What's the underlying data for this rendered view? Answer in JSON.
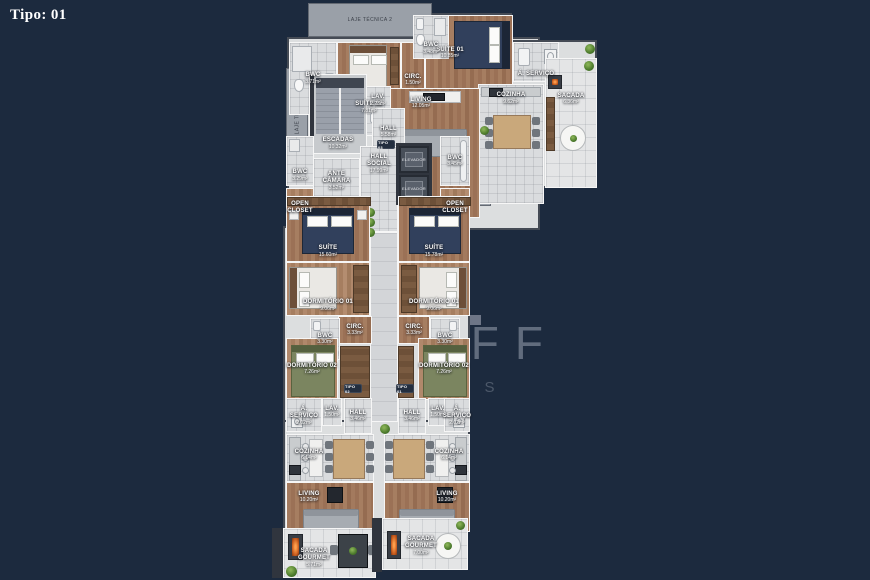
{
  "page": {
    "label": "Tipo: 01"
  },
  "watermark": {
    "brand": "WOLFF",
    "sub": "IMÓVEIS"
  },
  "colors": {
    "background": "#1c2a3e",
    "watermark": "#6e7888",
    "wood_floor": "#9c7156",
    "tile_floor": "#dadcde",
    "wall": "#454b55",
    "suite_bed": "#31405c",
    "grill_fire": "#c75b1e"
  },
  "strips": {
    "laje1": "LAJE TÉCNICA 1",
    "laje2": "LAJE TÉCNICA 2",
    "laje3": "LAJE TÉCNICA 3"
  },
  "tags": {
    "tipo01": "TIPO 01",
    "tipo02": "TIPO 02",
    "tipo03": "TIPO 03"
  },
  "rooms": {
    "bwc_top_left": {
      "name": "BWC",
      "area": "3.71m²"
    },
    "suite02": {
      "name": "SUÍTE 02",
      "area": "7.81m²"
    },
    "circ_top": {
      "name": "CIRC.",
      "area": "1.50m²"
    },
    "bwc_suite01": {
      "name": "BWC",
      "area": "3.48m²"
    },
    "suite01": {
      "name": "SUÍTE 01",
      "area": "10.85m²"
    },
    "servico_top": {
      "name": "Á. SERVIÇO",
      "area": ""
    },
    "cozinha_top": {
      "name": "COZINHA",
      "area": "9.62m²"
    },
    "sacada_top": {
      "name": "SACADA",
      "area": "6.36m²"
    },
    "living_top": {
      "name": "LIVING",
      "area": "12.05m²"
    },
    "lav_top": {
      "name": "LAV.",
      "area": "2.28m²"
    },
    "hall_top": {
      "name": "HALL",
      "area": "5.58m²"
    },
    "escadas": {
      "name": "ESCADAS",
      "area": "10.32m²"
    },
    "hall_social": {
      "name": "HALL SOCIAL",
      "area": "17.99m²"
    },
    "ante_camara": {
      "name": "ANTE CÂMARA",
      "area": "3.52m²"
    },
    "elevador": {
      "name": "ELEVADOR"
    },
    "bwc_mid_left": {
      "name": "BWC",
      "area": "3.29m²"
    },
    "open_closet_left": {
      "name": "OPEN CLOSET"
    },
    "bwc_mid_right": {
      "name": "BWC",
      "area": "3.45m²"
    },
    "open_closet_right": {
      "name": "OPEN CLOSET"
    },
    "suite_left": {
      "name": "SUÍTE",
      "area": "15.60m²"
    },
    "suite_right": {
      "name": "SUÍTE",
      "area": "15.78m²"
    },
    "dorm1_left": {
      "name": "DORMITÓRIO 01",
      "area": "9.06m²"
    },
    "dorm1_right": {
      "name": "DORMITÓRIO 01",
      "area": "9.06m²"
    },
    "circ_left": {
      "name": "CIRC.",
      "area": "3.33m²"
    },
    "circ_right": {
      "name": "CIRC.",
      "area": "3.33m²"
    },
    "bwc_low_left": {
      "name": "BWC",
      "area": "3.30m²"
    },
    "bwc_low_right": {
      "name": "BWC",
      "area": "3.30m²"
    },
    "dorm2_left": {
      "name": "DORMITÓRIO 02",
      "area": "7.26m²"
    },
    "dorm2_right": {
      "name": "DORMITÓRIO 02",
      "area": "7.26m²"
    },
    "lav_bot_left": {
      "name": "LAV.",
      "area": "1.50m²"
    },
    "lav_bot_right": {
      "name": "LAV.",
      "area": "1.50m²"
    },
    "servico_bot_left": {
      "name": "Á. SERVIÇO",
      "area": "2.02m²"
    },
    "servico_bot_right": {
      "name": "Á. SERVIÇO",
      "area": "2.02m²"
    },
    "hall_bot_left": {
      "name": "HALL",
      "area": "3.46m²"
    },
    "hall_bot_right": {
      "name": "HALL",
      "area": "3.46m²"
    },
    "cozinha_bot_left": {
      "name": "COZINHA",
      "area": "6.14m²"
    },
    "cozinha_bot_right": {
      "name": "COZINHA",
      "area": "6.14m²"
    },
    "living_bot_left": {
      "name": "LIVING",
      "area": "10.20m²"
    },
    "living_bot_right": {
      "name": "LIVING",
      "area": "10.20m²"
    },
    "sacada_g_left": {
      "name": "SACADA GOURMET",
      "area": "5.71m²"
    },
    "sacada_g_right": {
      "name": "SACADA GOURMET",
      "area": "7.00m²"
    }
  }
}
